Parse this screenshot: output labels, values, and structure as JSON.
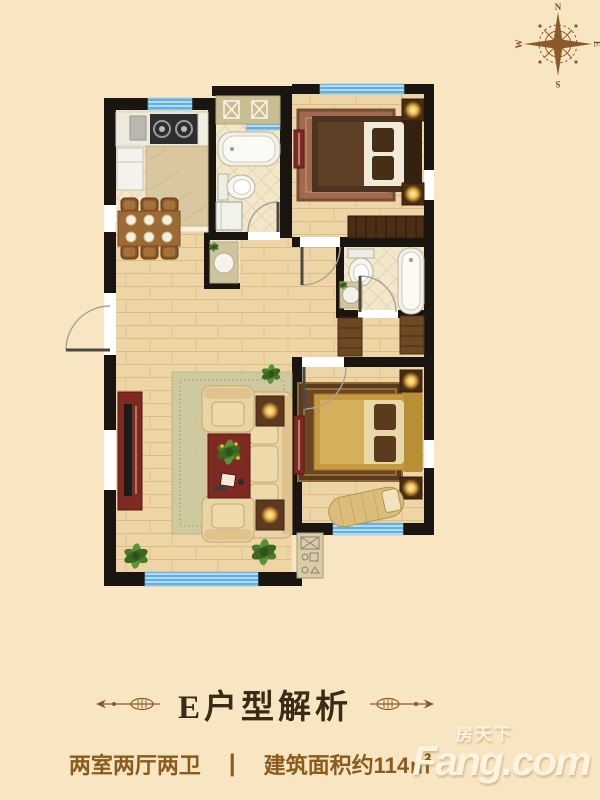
{
  "page": {
    "background": "#f8e5c2"
  },
  "compass": {
    "n": "N",
    "e": "E",
    "s": "S",
    "w": "W",
    "color": "#8b5a2b"
  },
  "floorplan": {
    "colors": {
      "wall": "#1a1511",
      "window_blue": "#5fb0e0",
      "wood_floor": "#eed5a6",
      "tile_floor": "#f3e7c9",
      "sofa_cream": "#e9d4a6",
      "accent_red": "#7e2a22",
      "bed_gold": "#c59a3f",
      "closet_brown": "#6e4723"
    }
  },
  "caption": {
    "title": "E户型解析"
  },
  "specs": {
    "layout": "两室两厅两卫",
    "divider": "|",
    "area": "建筑面积约114㎡"
  },
  "logo": {
    "cn": "房天下",
    "en": "Fang.com"
  }
}
